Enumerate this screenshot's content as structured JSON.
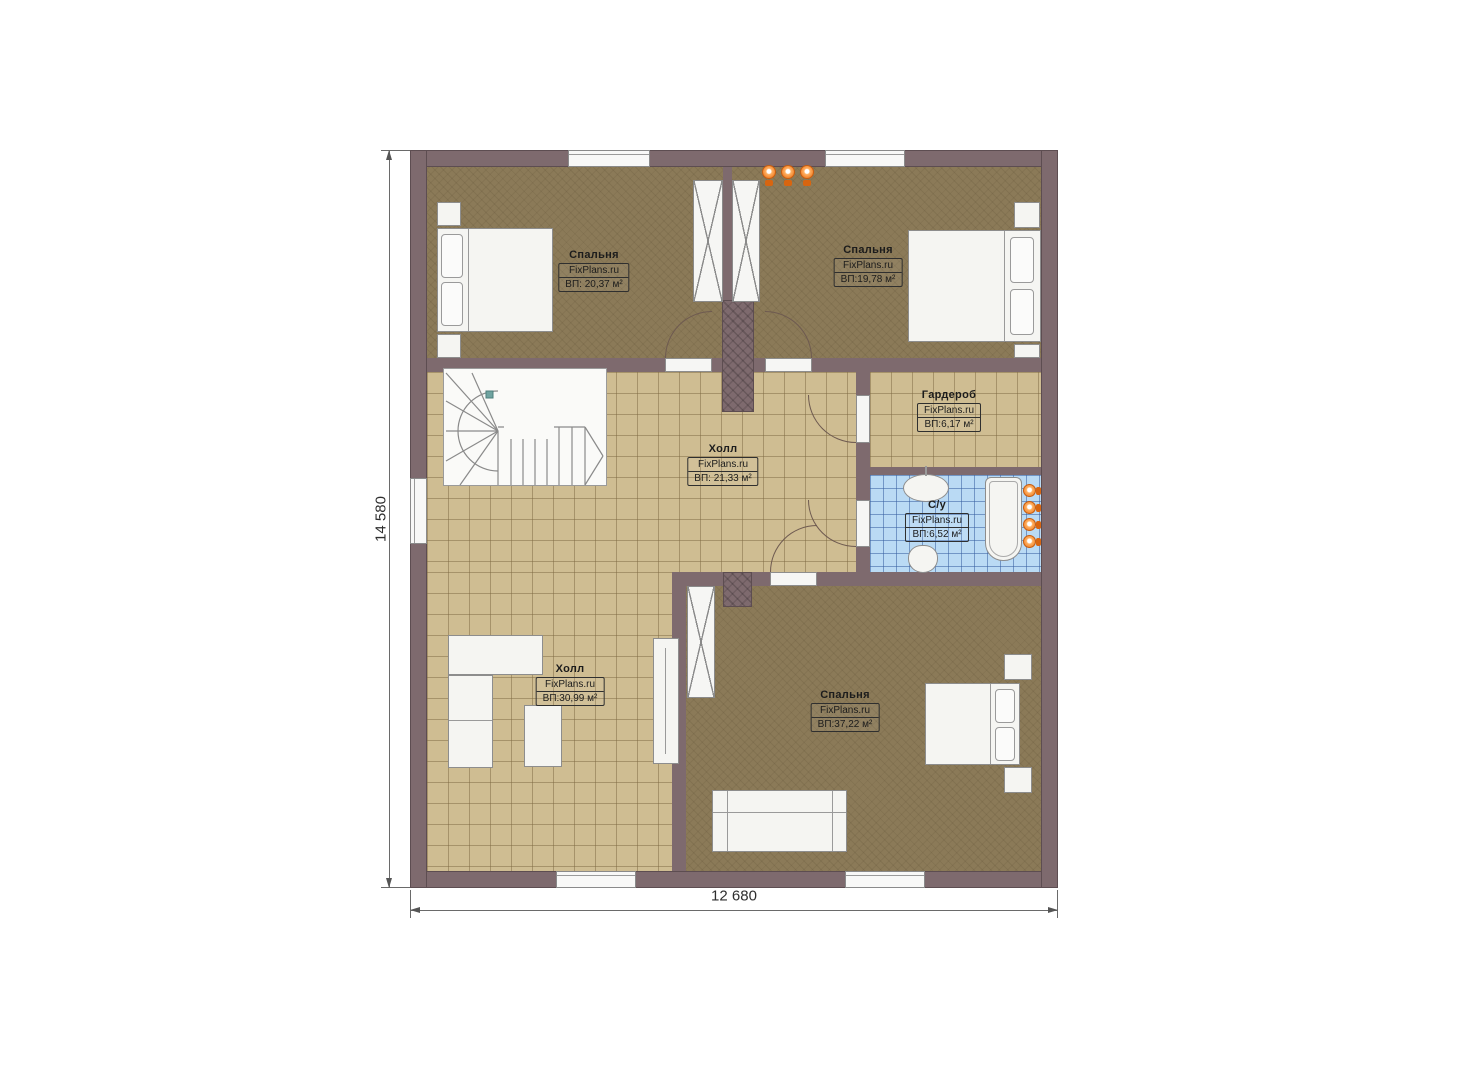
{
  "brand": "FixPlans.ru",
  "dimensions": {
    "height_label": "14 580",
    "width_label": "12 680"
  },
  "rooms": [
    {
      "name": "Спальня",
      "brand": "FixPlans.ru",
      "area": "ВП: 20,37 м²"
    },
    {
      "name": "Спальня",
      "brand": "FixPlans.ru",
      "area": "ВП:19,78 м²"
    },
    {
      "name": "Гардероб",
      "brand": "FixPlans.ru",
      "area": "ВП:6,17 м²"
    },
    {
      "name": "Холл",
      "brand": "FixPlans.ru",
      "area": "ВП: 21,33 м²"
    },
    {
      "name": "С/у",
      "brand": "FixPlans.ru",
      "area": "ВП:6,52 м²"
    },
    {
      "name": "Холл",
      "brand": "FixPlans.ru",
      "area": "ВП:30,99 м²"
    },
    {
      "name": "Спальня",
      "brand": "FixPlans.ru",
      "area": "ВП:37,22 м²"
    }
  ],
  "icons": {
    "wall_lamp": "orange-wall-lamp-icon"
  },
  "colors": {
    "wall": "#7e6a6e",
    "floor_wood": "#8b7a58",
    "tile_beige": "#cfbd92",
    "tile_blue": "#badaf4",
    "light_orange": "#ed7117"
  }
}
